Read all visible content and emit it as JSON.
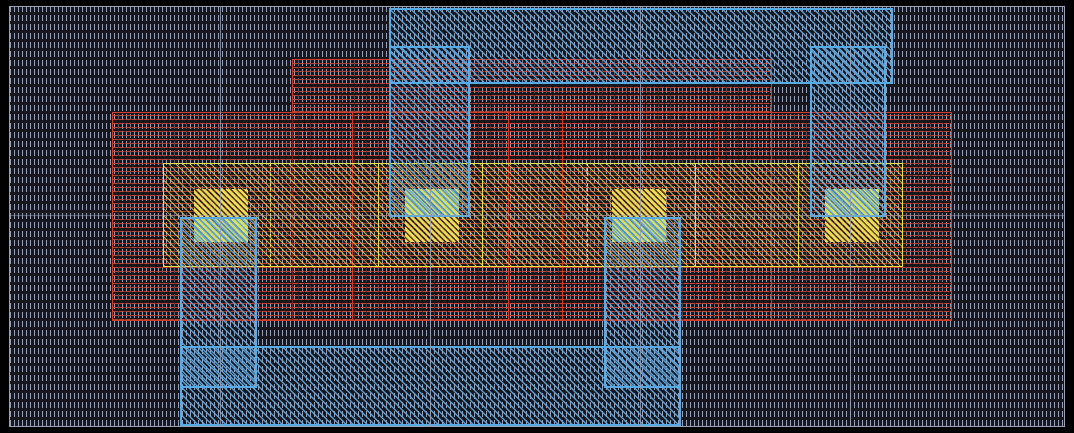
{
  "canvas": {
    "width": 1074,
    "height": 433,
    "background_color": "#000000"
  },
  "palette": {
    "substrate_hatch": "#969eb5",
    "substrate_border": "#9aa2b8",
    "poly_red": "#d23b28",
    "active_yellow": "#e9e14a",
    "metal_blue": "#58ace6",
    "contact_yellow": "#eade52",
    "contact_metal_green": "#aac95a",
    "guide_gray": "#949cb0"
  },
  "shapes": [
    {
      "name": "substrate-well-region",
      "cls": "bg",
      "x": 9,
      "y": 6,
      "w": 1056,
      "h": 421
    },
    {
      "name": "poly-plate-upper",
      "cls": "red",
      "x": 292,
      "y": 59,
      "w": 480,
      "h": 262
    },
    {
      "name": "poly-plate-main",
      "cls": "red",
      "x": 112,
      "y": 112,
      "w": 840,
      "h": 209
    },
    {
      "name": "poly-gate-edge-1",
      "cls": "redline",
      "x": 352,
      "y": 112,
      "w": 0,
      "h": 209
    },
    {
      "name": "poly-gate-edge-2",
      "cls": "redline",
      "x": 508,
      "y": 112,
      "w": 0,
      "h": 209
    },
    {
      "name": "poly-gate-edge-3",
      "cls": "redline",
      "x": 562,
      "y": 112,
      "w": 0,
      "h": 209
    },
    {
      "name": "poly-gate-edge-4",
      "cls": "redline-dashed",
      "x": 718,
      "y": 112,
      "w": 0,
      "h": 209
    },
    {
      "name": "active-diffusion-band",
      "cls": "active",
      "x": 163,
      "y": 163,
      "w": 740,
      "h": 104
    },
    {
      "name": "active-edge-dashed-1",
      "cls": "yline-dashed",
      "x": 270,
      "y": 163,
      "w": 0,
      "h": 104
    },
    {
      "name": "active-edge-solid-1",
      "cls": "yline",
      "x": 378,
      "y": 163,
      "w": 0,
      "h": 104
    },
    {
      "name": "active-edge-solid-2",
      "cls": "yline",
      "x": 482,
      "y": 163,
      "w": 0,
      "h": 104
    },
    {
      "name": "active-edge-dashed-2",
      "cls": "yline-dashed",
      "x": 587,
      "y": 163,
      "w": 0,
      "h": 104
    },
    {
      "name": "active-edge-solid-3",
      "cls": "yline",
      "x": 695,
      "y": 163,
      "w": 0,
      "h": 104
    },
    {
      "name": "active-edge-solid-4",
      "cls": "yline",
      "x": 798,
      "y": 163,
      "w": 0,
      "h": 104
    }
  ],
  "contacts": [
    {
      "name": "contact-1",
      "x": 194,
      "y": 189,
      "w": 54,
      "h": 53,
      "split_y": 217,
      "metal_side": "bottom"
    },
    {
      "name": "contact-2",
      "x": 405,
      "y": 189,
      "w": 54,
      "h": 53,
      "split_y": 217,
      "metal_side": "top"
    },
    {
      "name": "contact-3",
      "x": 612,
      "y": 189,
      "w": 54,
      "h": 53,
      "split_y": 217,
      "metal_side": "bottom"
    },
    {
      "name": "contact-4",
      "x": 825,
      "y": 189,
      "w": 54,
      "h": 53,
      "split_y": 217,
      "metal_side": "top"
    }
  ],
  "metal_shapes": [
    {
      "name": "metal-top-rail",
      "cls": "blue",
      "x": 389,
      "y": 8,
      "w": 504,
      "h": 76
    },
    {
      "name": "metal-bottom-rail",
      "cls": "blue",
      "x": 180,
      "y": 346,
      "w": 501,
      "h": 80
    },
    {
      "name": "metal-tab-contact-1",
      "cls": "blue",
      "x": 180,
      "y": 217,
      "w": 77,
      "h": 171
    },
    {
      "name": "metal-tab-contact-2",
      "cls": "blue",
      "x": 389,
      "y": 46,
      "w": 81,
      "h": 171
    },
    {
      "name": "metal-tab-contact-3",
      "cls": "blue",
      "x": 604,
      "y": 217,
      "w": 77,
      "h": 171
    },
    {
      "name": "metal-tab-contact-4",
      "cls": "blue",
      "x": 810,
      "y": 46,
      "w": 76,
      "h": 171
    }
  ],
  "guides": {
    "vertical_x": [
      220,
      430,
      640,
      850
    ],
    "vertical_span": {
      "y": 7,
      "h": 420
    },
    "horizontal_y": 215,
    "horizontal_span": {
      "x": 9,
      "w": 1056
    }
  }
}
